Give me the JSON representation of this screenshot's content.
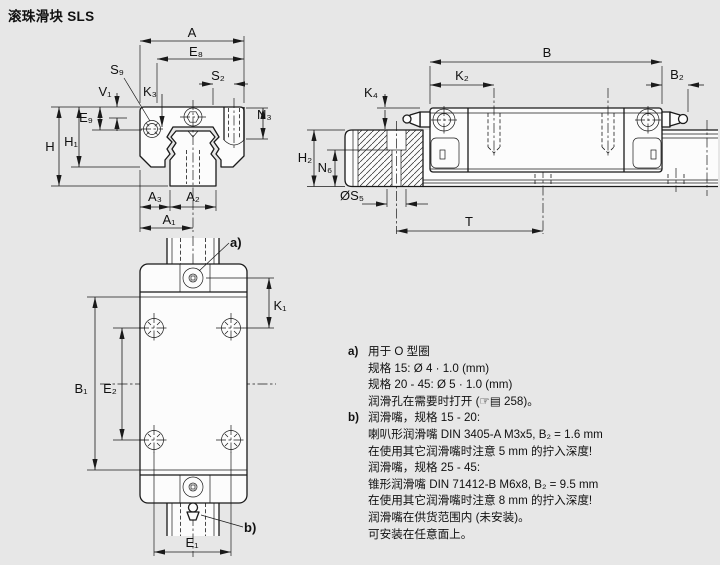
{
  "page": {
    "title": "滚珠滑块 SLS"
  },
  "colors": {
    "background": "#e7e7e7",
    "line": "#1a1a1a",
    "face": "#fcfcfc"
  },
  "front": {
    "A": "A",
    "E8": "E₈",
    "S9": "S₉",
    "V1": "V₁",
    "K3": "K₃",
    "S2": "S₂",
    "N3": "N₃",
    "E9": "E₉",
    "H1": "H₁",
    "H": "H",
    "A3": "A₃",
    "A2": "A₂",
    "A1": "A₁"
  },
  "side": {
    "B": "B",
    "K2": "K₂",
    "B2": "B₂",
    "K4": "K₄",
    "H2": "H₂",
    "N6": "N₆",
    "S5": "ØS₅",
    "T": "T"
  },
  "top": {
    "K1": "K₁",
    "B1": "B₁",
    "E2": "E₂",
    "E1": "E₁",
    "a": "a)",
    "b": "b)"
  },
  "notes": {
    "a": {
      "marker": "a)",
      "lines": [
        "用于 O 型圈",
        "规格 15: Ø 4 · 1.0 (mm)",
        "规格 20 - 45: Ø 5 · 1.0 (mm)",
        "润滑孔在需要时打开 (☞▤ 258)。"
      ]
    },
    "b": {
      "marker": "b)",
      "lines": [
        "润滑嘴，规格 15 - 20:",
        "喇叭形润滑嘴 DIN 3405-A M3x5, B₂ = 1.6 mm",
        "在使用其它润滑嘴时注意 5 mm 的拧入深度!",
        "润滑嘴，规格 25 - 45:",
        "锥形润滑嘴 DIN 71412-B M6x8, B₂ = 9.5 mm",
        "在使用其它润滑嘴时注意 8 mm 的拧入深度!",
        "润滑嘴在供货范围内 (未安装)。",
        "可安装在任意面上。"
      ]
    }
  }
}
